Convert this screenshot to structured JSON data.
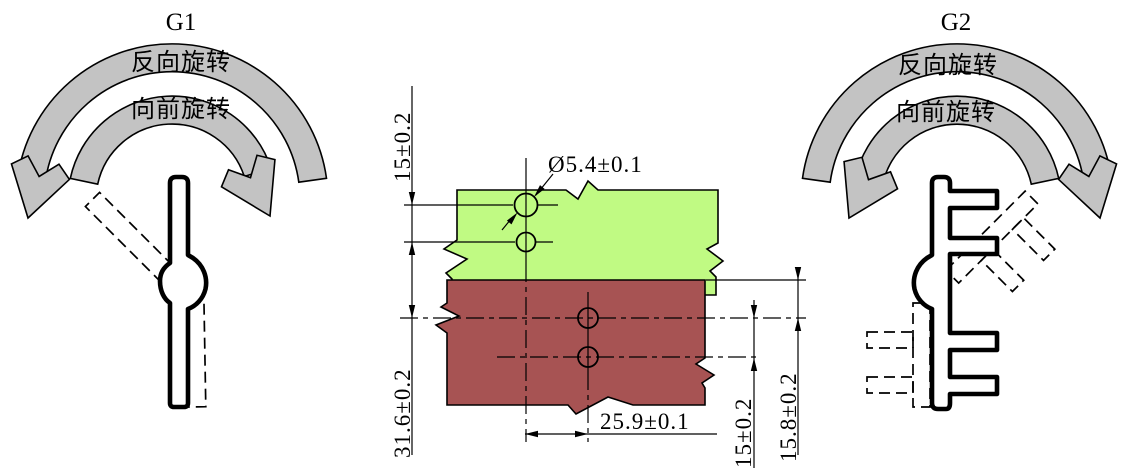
{
  "g1": {
    "title": "G1",
    "reverse_label": "反向旋转",
    "forward_label": "向前旋转"
  },
  "g2": {
    "title": "G2",
    "reverse_label": "反向旋转",
    "forward_label": "向前旋转"
  },
  "drawing": {
    "dims": {
      "green_hole_pitch": "15±0.2",
      "green_to_red": "31.6±0.2",
      "hole_dia": "Ø5.4±0.1",
      "offset": "25.9±0.1",
      "red_hole_pitch": "15±0.2",
      "red_edge_to_hole": "15.8±0.2"
    },
    "colors": {
      "green_panel": "#c0fa83",
      "red_panel": "#a75353",
      "arrow_gray": "#c3c3c3"
    }
  }
}
